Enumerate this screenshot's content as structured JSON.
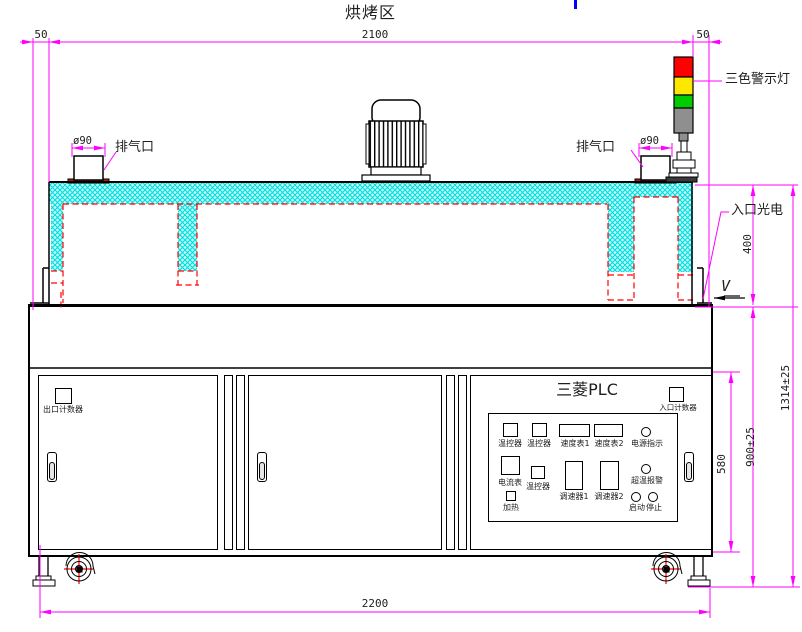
{
  "title": "烘烤区",
  "colors": {
    "dimension_pink": "#FF00FF",
    "insulation_cyan": "#00DCDC",
    "chamber_red": "#FF0000",
    "lamp_red": "#FF0000",
    "lamp_yellow": "#FFE800",
    "lamp_green": "#00CC00",
    "lamp_gray": "#8F8F8F",
    "base_dark": "#3a3a3a",
    "cursor_blue": "#0000FF"
  },
  "top_dims": {
    "left_offset": "50",
    "width": "2100",
    "right_offset": "50"
  },
  "exhaust_left": {
    "dia": "ø90",
    "label": "排气口"
  },
  "exhaust_right": {
    "dia": "ø90",
    "label": "排气口"
  },
  "warning_light_label": "三色警示灯",
  "entry_sensor_label": "入口光电",
  "direction_mark": "V",
  "side_dims": {
    "chamber_height": "400",
    "door_height": "580",
    "body_height": "900±25",
    "total_height": "1314±25"
  },
  "bottom_dim": "2200",
  "cabinet": {
    "exit_counter_label": "出口计数器"
  },
  "control_panel": {
    "title": "三菱PLC",
    "entry_counter_label": "入口计数器",
    "row1": [
      {
        "label": "温控器"
      },
      {
        "label": "温控器"
      },
      {
        "label": "速度表1"
      },
      {
        "label": "速度表2"
      },
      {
        "label": "电源指示"
      }
    ],
    "row2": [
      {
        "label": "电流表"
      },
      {
        "label": "温控器"
      },
      {
        "label": "调速器1"
      },
      {
        "label": "调速器2"
      },
      {
        "label": "超温报警"
      }
    ],
    "row3": [
      {
        "label": "加热"
      },
      {
        "label": "启动"
      },
      {
        "label": "停止"
      }
    ]
  }
}
